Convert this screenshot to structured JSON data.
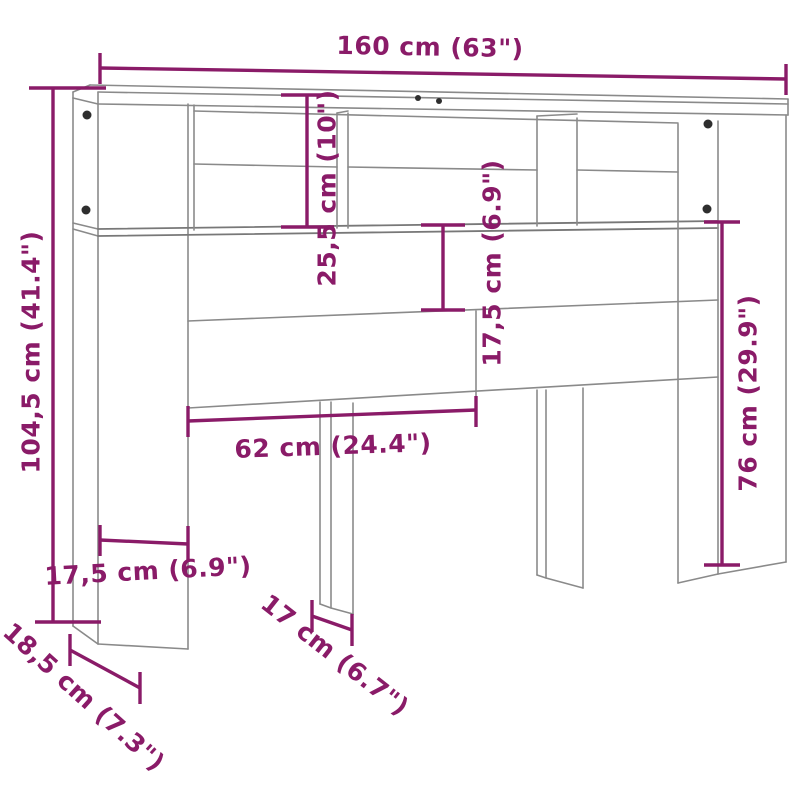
{
  "diagram": {
    "title": "Headboard cabinet dimension diagram",
    "subject": "headboard-cabinet-line-drawing",
    "units": "cm (inches)",
    "colors": {
      "dimension_accent": "#8A1B68",
      "outline_gray": "#8a8a8a",
      "pin_dark": "#2e2e2e",
      "background": "#ffffff"
    },
    "dimensions": [
      {
        "name": "overall-width",
        "label": "160 cm (63\")"
      },
      {
        "name": "overall-height",
        "label": "104,5 cm (41.4\")"
      },
      {
        "name": "top-compartment-height",
        "label": "25,5 cm (10\")"
      },
      {
        "name": "back-panel-drop-height",
        "label": "17,5 cm (6.9\")"
      },
      {
        "name": "floor-clearance-height",
        "label": "76 cm (29.9\")"
      },
      {
        "name": "opening-width",
        "label": "62 cm (24.4\")"
      },
      {
        "name": "side-column-width",
        "label": "17,5 cm (6.9\")"
      },
      {
        "name": "leg-depth",
        "label": "17 cm (6.7\")"
      },
      {
        "name": "side-column-depth",
        "label": "18,5 cm (7.3\")"
      }
    ]
  }
}
